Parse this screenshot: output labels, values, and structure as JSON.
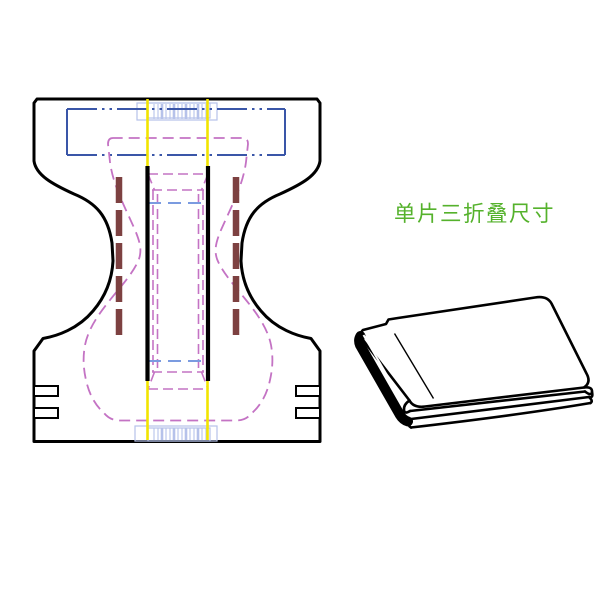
{
  "caption": {
    "text": "单片三折叠尺寸"
  },
  "colors": {
    "bg": "#ffffff",
    "line": "#000000",
    "blue": "#3a56a8",
    "lightblue": "#b6c2ea",
    "midblue": "#7b9be0",
    "yellow": "#f2e400",
    "magenta": "#c473c4",
    "maroon": "#7d4141",
    "green": "#55b22c"
  }
}
